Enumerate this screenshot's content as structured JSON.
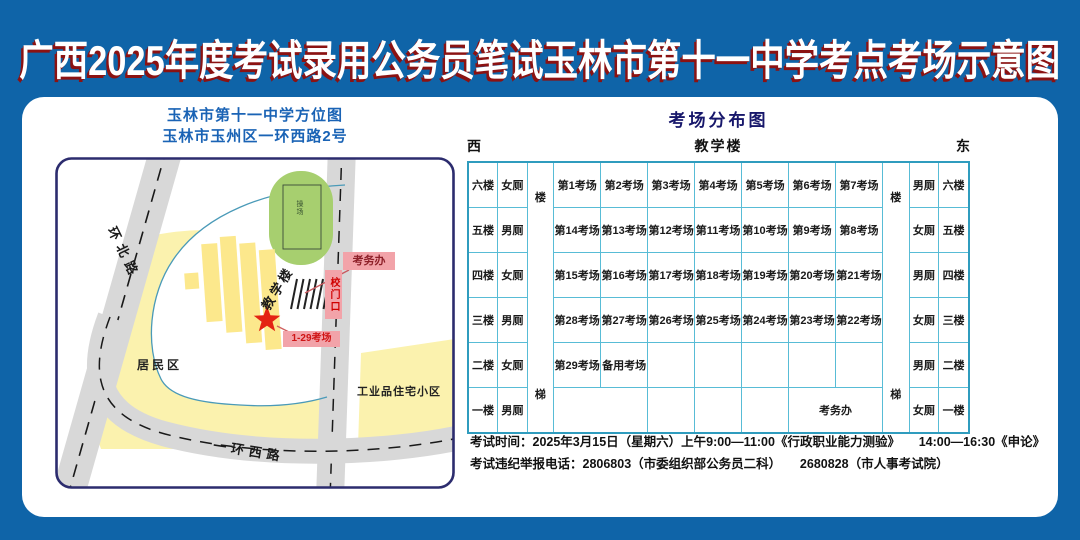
{
  "title": "广西2025年度考试录用公务员笔试玉林市第十一中学考点考场示意图",
  "map": {
    "title_line1": "玉林市第十一中学方位图",
    "title_line2": "玉林市玉州区一环西路2号",
    "labels": {
      "road_north": "环北路",
      "road_west": "一环西路",
      "playground": "操场",
      "teaching_building": "教学楼",
      "exam_office": "考务办",
      "school_gate": "校门口",
      "rooms_range": "1-29考场",
      "residential": "居民区",
      "industrial": "工业品住宅小区"
    }
  },
  "distribution": {
    "title": "考场分布图",
    "west": "西",
    "east": "东",
    "building": "教学楼",
    "stairs": "楼梯"
  },
  "table": {
    "rows": [
      {
        "floor": "六楼",
        "toilet_left": "女厕",
        "toilet_right": "男厕",
        "cells": [
          {
            "t": "第1考场"
          },
          {
            "t": "第2考场"
          },
          {
            "t": "第3考场"
          },
          {
            "t": "第4考场"
          },
          {
            "t": "第5考场"
          },
          {
            "t": "第6考场"
          },
          {
            "t": "第7考场"
          }
        ]
      },
      {
        "floor": "五楼",
        "toilet_left": "男厕",
        "toilet_right": "女厕",
        "cells": [
          {
            "t": "第14考场"
          },
          {
            "t": "第13考场"
          },
          {
            "t": "第12考场"
          },
          {
            "t": "第11考场"
          },
          {
            "t": "第10考场"
          },
          {
            "t": "第9考场"
          },
          {
            "t": "第8考场"
          }
        ]
      },
      {
        "floor": "四楼",
        "toilet_left": "女厕",
        "toilet_right": "男厕",
        "cells": [
          {
            "t": "第15考场"
          },
          {
            "t": "第16考场"
          },
          {
            "t": "第17考场"
          },
          {
            "t": "第18考场"
          },
          {
            "t": "第19考场"
          },
          {
            "t": "第20考场"
          },
          {
            "t": "第21考场"
          }
        ]
      },
      {
        "floor": "三楼",
        "toilet_left": "男厕",
        "toilet_right": "女厕",
        "cells": [
          {
            "t": "第28考场"
          },
          {
            "t": "第27考场"
          },
          {
            "t": "第26考场"
          },
          {
            "t": "第25考场"
          },
          {
            "t": "第24考场"
          },
          {
            "t": "第23考场"
          },
          {
            "t": "第22考场"
          }
        ]
      },
      {
        "floor": "二楼",
        "toilet_left": "女厕",
        "toilet_right": "男厕",
        "cells": [
          {
            "t": "第29考场"
          },
          {
            "t": "备用考场"
          },
          {
            "t": ""
          },
          {
            "t": ""
          },
          {
            "t": ""
          },
          {
            "t": ""
          },
          {
            "t": ""
          }
        ]
      },
      {
        "floor": "一楼",
        "toilet_left": "男厕",
        "toilet_right": "女厕",
        "cells": [
          {
            "t": "",
            "colspan": 2
          },
          {
            "t": ""
          },
          {
            "t": ""
          },
          {
            "t": ""
          },
          {
            "t": "考务办",
            "colspan": 2
          }
        ]
      }
    ]
  },
  "footer": {
    "line1": "考试时间：2025年3月15日（星期六）上午9:00—11:00《行政职业能力测验》　　14:00—16:30《申论》",
    "line2": "考试违纪举报电话：2806803（市委组织部公务员二科）　　2680828（市人事考试院）"
  }
}
